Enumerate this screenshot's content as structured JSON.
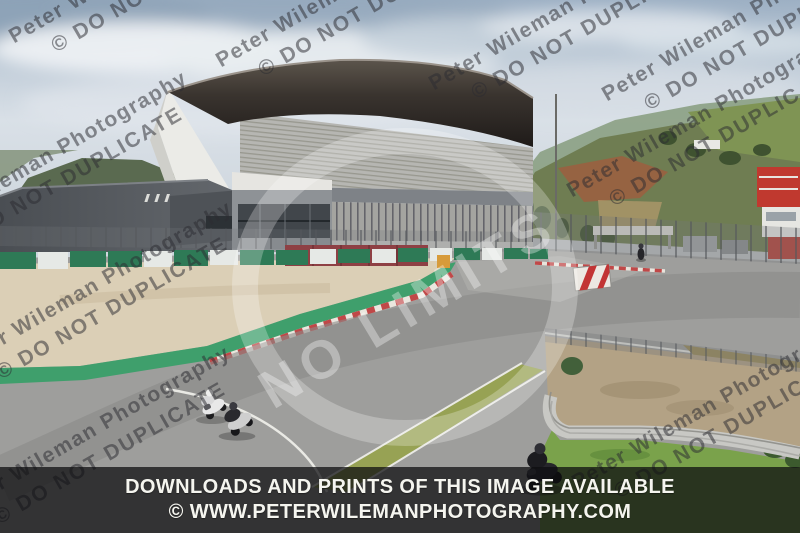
{
  "banner": {
    "line1": "DOWNLOADS AND PRINTS OF THIS IMAGE AVAILABLE",
    "line2": "© WWW.PETERWILEMANPHOTOGRAPHY.COM",
    "background": "rgba(14,14,16,0.74)",
    "text_color": "#f5f5ef"
  },
  "watermark": {
    "line1": "Peter Wileman Photography",
    "line2": "© DO NOT DUPLICATE",
    "rotation_deg": -30,
    "color": "rgba(45,45,50,0.52)",
    "tiles": [
      {
        "x": -95,
        "y": 225
      },
      {
        "x": 5,
        "y": 28
      },
      {
        "x": 212,
        "y": 52
      },
      {
        "x": 425,
        "y": 75
      },
      {
        "x": 563,
        "y": 182
      },
      {
        "x": 598,
        "y": 86
      },
      {
        "x": -50,
        "y": 355
      },
      {
        "x": -52,
        "y": 500
      },
      {
        "x": 568,
        "y": 474
      }
    ]
  },
  "center_watermark": {
    "text": "NO LIMITS",
    "x": 248,
    "y": 368,
    "rotation_deg": -31,
    "font_size_px": 54,
    "color": "#ffffff",
    "opacity": 0.34,
    "ring": {
      "cx": 405,
      "cy": 287,
      "rx": 160,
      "ry": 146,
      "opacity": 0.26
    }
  },
  "scene": {
    "subject": "motorcycles on race circuit in front of main grandstand",
    "motorcycles": [
      "white-sportsbike-leaning-left-pair",
      "dark-sportsbike-leaning-left-pair",
      "dark-motorcycle-lower-right",
      "distant-motorcycle-right"
    ],
    "colors": {
      "sky": "#c3cfdb",
      "track_gray": "#9e9e9c",
      "runoff_beige": "#dbcfb6",
      "painted_green_band": "#3f9f6c",
      "kerb_red": "#c04848",
      "tire_wall_green": "#2e7a56",
      "grass_center": "#97a254",
      "grass_right": "#7aa24b",
      "gravel": "#b3a285",
      "maroon_wall": "#8e4044",
      "grandstand_roof": "#37322e",
      "hill_green": "#6f7d52",
      "earth_red": "#9a6040",
      "marshal_tower_red": "#c23434"
    }
  }
}
